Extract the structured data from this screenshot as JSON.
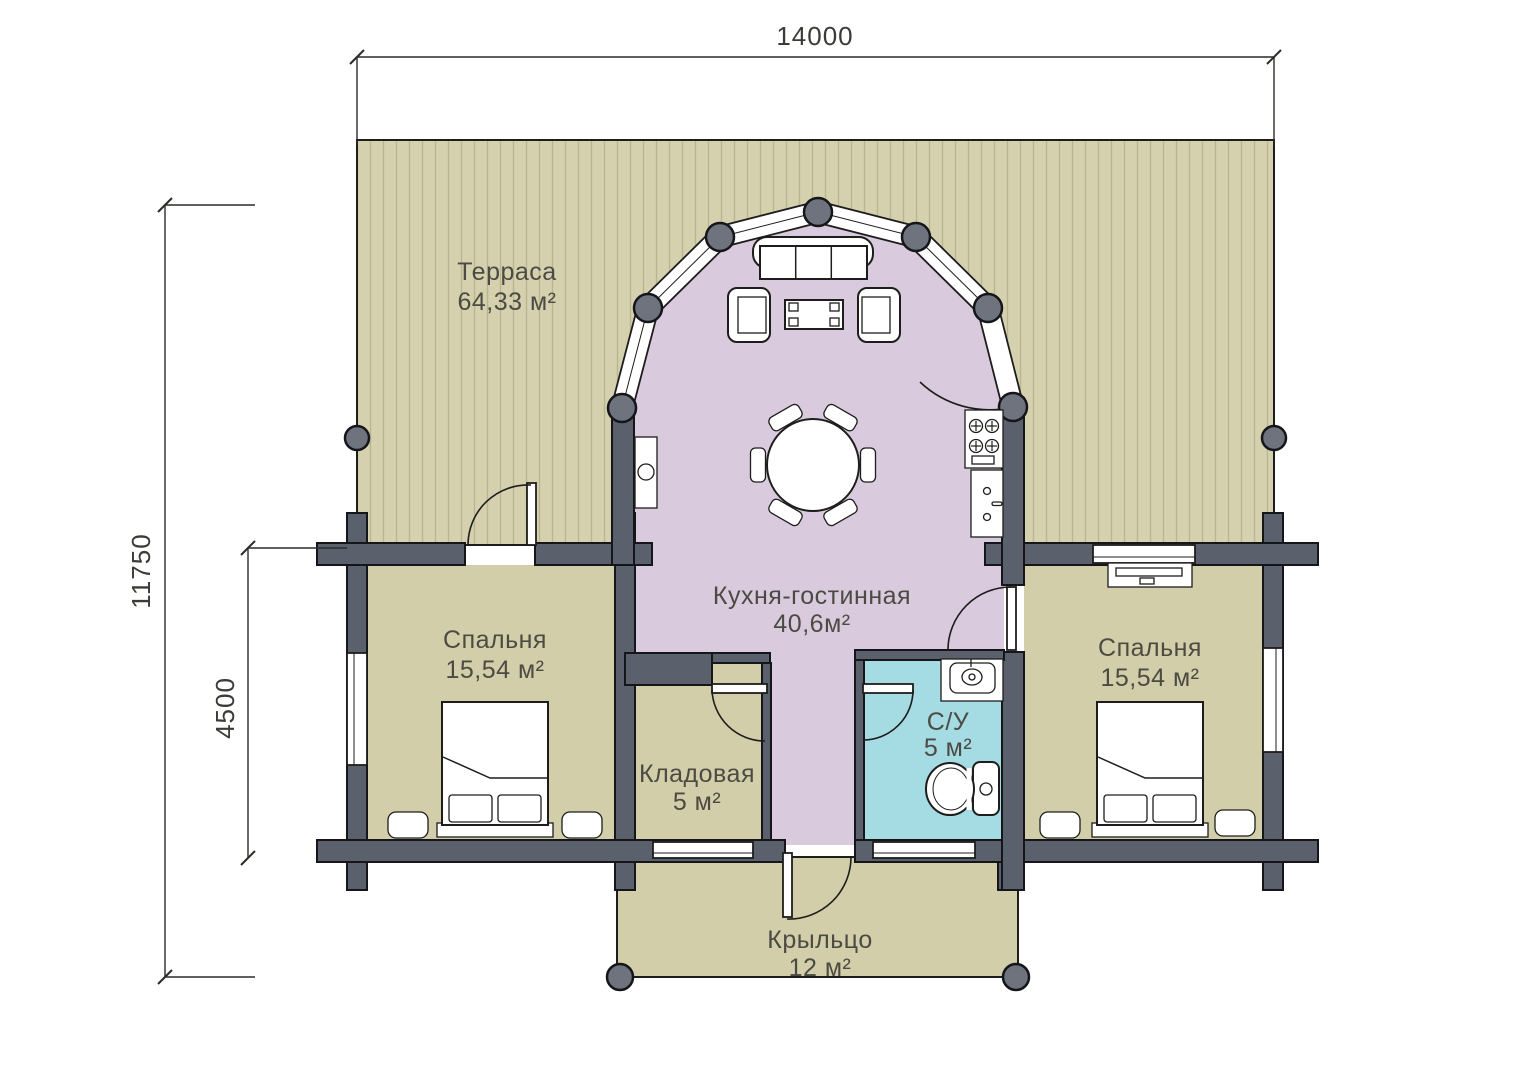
{
  "plan": {
    "title": "floor-plan",
    "dimensions": {
      "width_top": "14000",
      "height_left": "11750",
      "inner_left": "4500"
    },
    "rooms": {
      "terrace": {
        "name": "Терраса",
        "area": "64,33 м²",
        "color": "#d5d1ae"
      },
      "kitchen_living": {
        "name": "Кухня-гостинная",
        "area": "40,6м²",
        "color": "#d9cadd"
      },
      "bedroom_left": {
        "name": "Спальня",
        "area": "15,54 м²",
        "color": "#d2cea9"
      },
      "bedroom_right": {
        "name": "Спальня",
        "area": "15,54 м²",
        "color": "#d2cea9"
      },
      "storage": {
        "name": "Кладовая",
        "area": "5 м²",
        "color": "#d2cea9"
      },
      "bathroom": {
        "name": "С/У",
        "area": "5 м²",
        "color": "#a5dbe3"
      },
      "porch": {
        "name": "Крыльцо",
        "area": "12 м²",
        "color": "#d2cea9"
      }
    },
    "colors": {
      "wall": "#5b616c",
      "outline": "#1d1d1b",
      "post": "#6e737e",
      "stripe": "#b9b593",
      "label_text": "#4c4b43"
    }
  }
}
